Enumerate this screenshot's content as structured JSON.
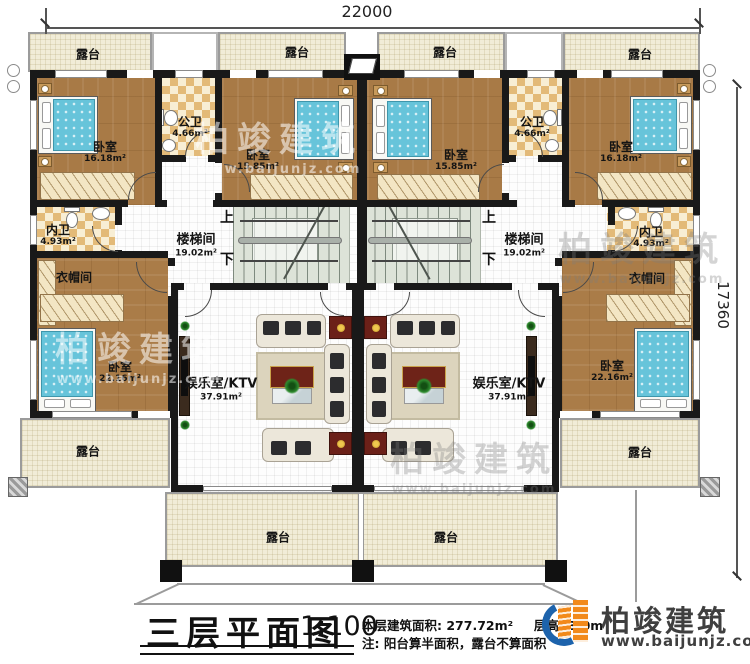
{
  "dimensions": {
    "width_top": "22000",
    "height_right": "17360"
  },
  "labels": {
    "terrace": "露台",
    "bedroom": "卧室",
    "public_bath": "公卫",
    "ensuite_bath": "内卫",
    "stairwell": "楼梯间",
    "cloakroom": "衣帽间",
    "ktv": "娱乐室/KTV",
    "up": "上",
    "down": "下"
  },
  "areas": {
    "bedroom_large": "16.18m²",
    "bedroom_mid": "15.85m²",
    "bedroom_master": "22.16m²",
    "public_bath": "4.66m²",
    "ensuite_bath": "4.93m²",
    "stairwell": "19.02m²",
    "ktv": "37.91m²"
  },
  "title_block": {
    "plan_title": "三层平面图",
    "scale": "1:100",
    "info_area": "本层建筑面积: 277.72m²",
    "info_height": "层高: 3.0m",
    "note": "注: 阳台算半面积，露台不算面积"
  },
  "branding": {
    "company": "柏竣建筑",
    "website": "www.baijunjz.com"
  },
  "watermark": {
    "company": "柏竣建筑",
    "website": "www.baijunjz.com"
  },
  "palette": {
    "wall": "#191919",
    "wood_floor": "#a87a46",
    "bath_tile": "#e3ba78",
    "terrace": "#f1ecd7",
    "stair": "#dde3d8",
    "bed_blue": "#67c4da",
    "tv_panel_red": "#6e2318",
    "logo_orange": "#f28a1b",
    "logo_blue": "#1d63ac"
  }
}
